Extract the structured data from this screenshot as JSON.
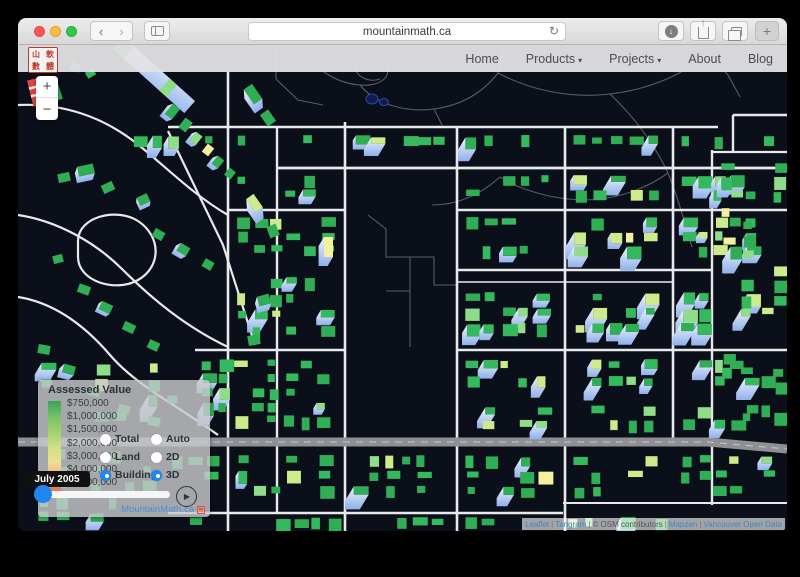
{
  "browser": {
    "url": "mountainmath.ca",
    "new_tab_label": "+",
    "back_glyph": "‹",
    "forward_glyph": "›",
    "reload_glyph": "↻",
    "download_glyph": "↓"
  },
  "site": {
    "logo_chars": [
      "山",
      "軟",
      "數",
      "體"
    ],
    "nav": [
      {
        "label": "Home",
        "dropdown": false
      },
      {
        "label": "Products",
        "dropdown": true
      },
      {
        "label": "Projects",
        "dropdown": true
      },
      {
        "label": "About",
        "dropdown": false
      },
      {
        "label": "Blog",
        "dropdown": false
      }
    ]
  },
  "map_controls": {
    "zoom_in": "+",
    "zoom_out": "−"
  },
  "legend": {
    "title": "Assessed Value",
    "values": [
      "$750,000",
      "$1,000,000",
      "$1,500,000",
      "$2,000,000",
      "$3,000,000",
      "$4,000,000",
      "$5,000,000"
    ],
    "colors": [
      "#3ba357",
      "#74c167",
      "#a3d16d",
      "#cde085",
      "#ecdf96",
      "#f0ab73",
      "#e26b55"
    ]
  },
  "controls": {
    "value_options": [
      {
        "label": "Total",
        "selected": false
      },
      {
        "label": "Land",
        "selected": false
      },
      {
        "label": "Building",
        "selected": true
      }
    ],
    "view_options": [
      {
        "label": "Auto",
        "selected": false
      },
      {
        "label": "2D",
        "selected": false
      },
      {
        "label": "3D",
        "selected": true
      }
    ]
  },
  "timeline": {
    "tooltip": "July 2005",
    "play_glyph": "▶"
  },
  "footer_link": {
    "label": "MountainMath.ca"
  },
  "attribution": {
    "separator": "|",
    "parts": [
      {
        "text": "Leaflet",
        "link": true
      },
      {
        "text": "Tangram",
        "link": true
      },
      {
        "text": "© OSM contributors",
        "link": false
      },
      {
        "text": "Mapzen",
        "link": true
      },
      {
        "text": "Vancouver Open Data",
        "link": true
      }
    ]
  },
  "colors": {
    "accent_blue": "#1e87f2",
    "link_blue": "#4a90d9",
    "map_background": "#0b0f19",
    "street_white": "#e9e9ec",
    "arterial_gray": "#8f9094",
    "building_green": "#2fae55",
    "building_light_green": "#8fdc8a",
    "building_yellow_green": "#cdeb8b",
    "building_yellow": "#f4f0a0",
    "extrusion_blue_top": "#eef3fd",
    "extrusion_blue_bottom": "#8fb0ea",
    "high_value_red": "#e0463e"
  }
}
